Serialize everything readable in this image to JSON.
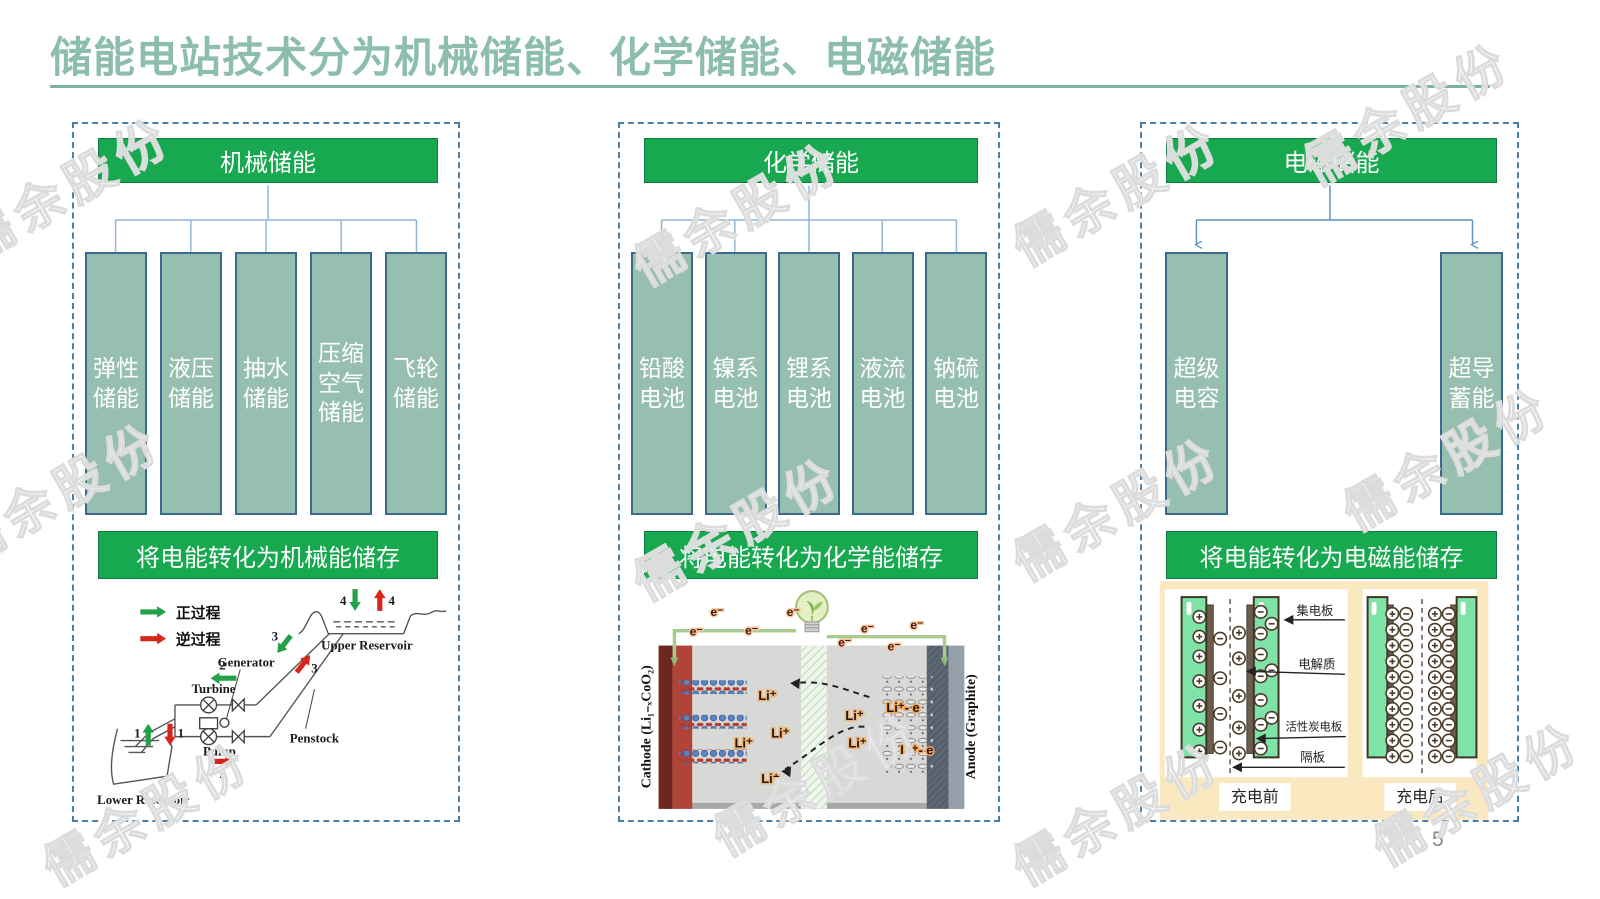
{
  "title": {
    "text": "储能电站技术分为机械储能、化学储能、电磁储能"
  },
  "watermark": {
    "text": "儒余股份"
  },
  "page_number": "5",
  "colors": {
    "title_green": "#8CBEAB",
    "header_green": "#17A850",
    "box_sage": "#97BFB0",
    "box_border": "#3A6B8F",
    "connector_blue": "#8FB4D9",
    "panel_dashed_border": "#4D7FA6",
    "arrow_green": "#22A04A",
    "arrow_red": "#D6251B",
    "supercap_plate_green": "#7FE2A7",
    "supercap_bg_cream": "#FAE8C1"
  },
  "panels": [
    {
      "header": "机械储能",
      "items": [
        "弹性储能",
        "液压储能",
        "抽水储能",
        "压缩空气储能",
        "飞轮储能"
      ],
      "banner": "将电能转化为机械能储存",
      "diagram": {
        "legend_forward": "正过程",
        "legend_reverse": "逆过程",
        "upper_reservoir": "Upper Reservoir",
        "lower_reservoir": "Lower Reservoir",
        "generator": "Generator",
        "turbine": "Turbine",
        "pump": "Pump",
        "penstock": "Penstock",
        "n1": "1",
        "n2": "2",
        "n3": "3",
        "n4": "4"
      }
    },
    {
      "header": "化学储能",
      "items": [
        "铅酸电池",
        "镍系电池",
        "锂系电池",
        "液流电池",
        "钠硫电池"
      ],
      "banner": "将电能转化为化学能储存",
      "diagram": {
        "cathode_label": "Cathode (Li₁₋ₓCoO₂)",
        "anode_label": "Anode (Graphite)",
        "e_label": "e⁻",
        "li_label": "Li⁺",
        "li_e_label": "Li⁺- e"
      }
    },
    {
      "header": "电磁储能",
      "items": [
        "超级电容",
        "超导蓄能"
      ],
      "banner": "将电能转化为电磁能储存",
      "diagram": {
        "collector_label": "集电板",
        "electrolyte_label": "电解质",
        "carbon_label": "活性炭电板",
        "separator_label": "隔板",
        "before_label": "充电前",
        "after_label": "充电后"
      }
    }
  ]
}
